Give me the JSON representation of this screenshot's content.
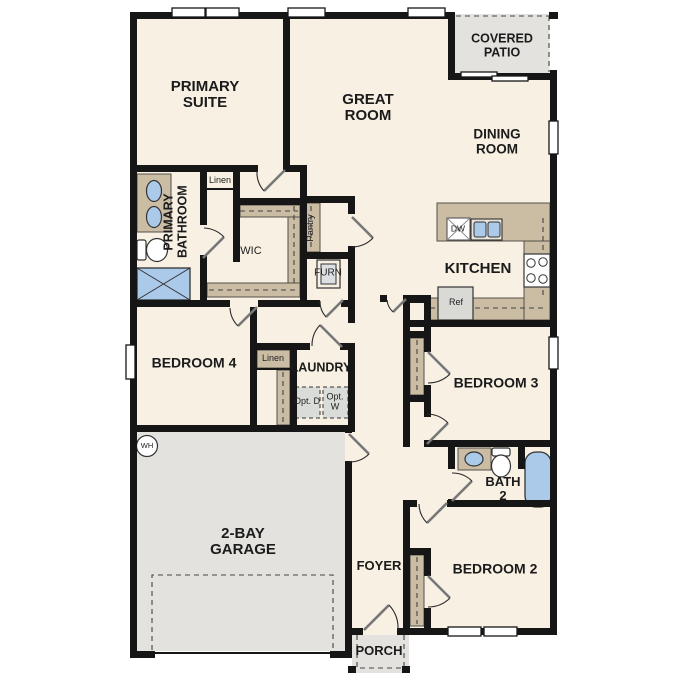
{
  "plan_title": "single-story floor plan",
  "colors": {
    "floor": "#f7f0e3",
    "wall": "#161616",
    "casework_tan": "#cbbca4",
    "outdoor_gray": "#e3e2de",
    "fixture_blue": "#abc9e8",
    "appliance_gray": "#d9d9d6"
  },
  "labels": {
    "primary_suite": "PRIMARY SUITE",
    "great_room": "GREAT ROOM",
    "covered_patio": "COVERED PATIO",
    "dining_room": "DINING ROOM",
    "kitchen": "KITCHEN",
    "primary_bathroom": "PRIMARY BATHROOM",
    "wic": "WIC",
    "linen1": "Linen",
    "linen2": "Linen",
    "pantry": "Pantry",
    "furn": "FURN",
    "dw": "DW",
    "ref": "Ref",
    "wh": "WH",
    "bedroom4": "BEDROOM 4",
    "laundry": "LAUNDRY",
    "opt_d": "Opt. D",
    "opt_w": "Opt. W",
    "garage": "2-BAY GARAGE",
    "bedroom3": "BEDROOM 3",
    "bath2": "BATH 2",
    "bedroom2": "BEDROOM 2",
    "foyer": "FOYER",
    "porch": "PORCH"
  }
}
